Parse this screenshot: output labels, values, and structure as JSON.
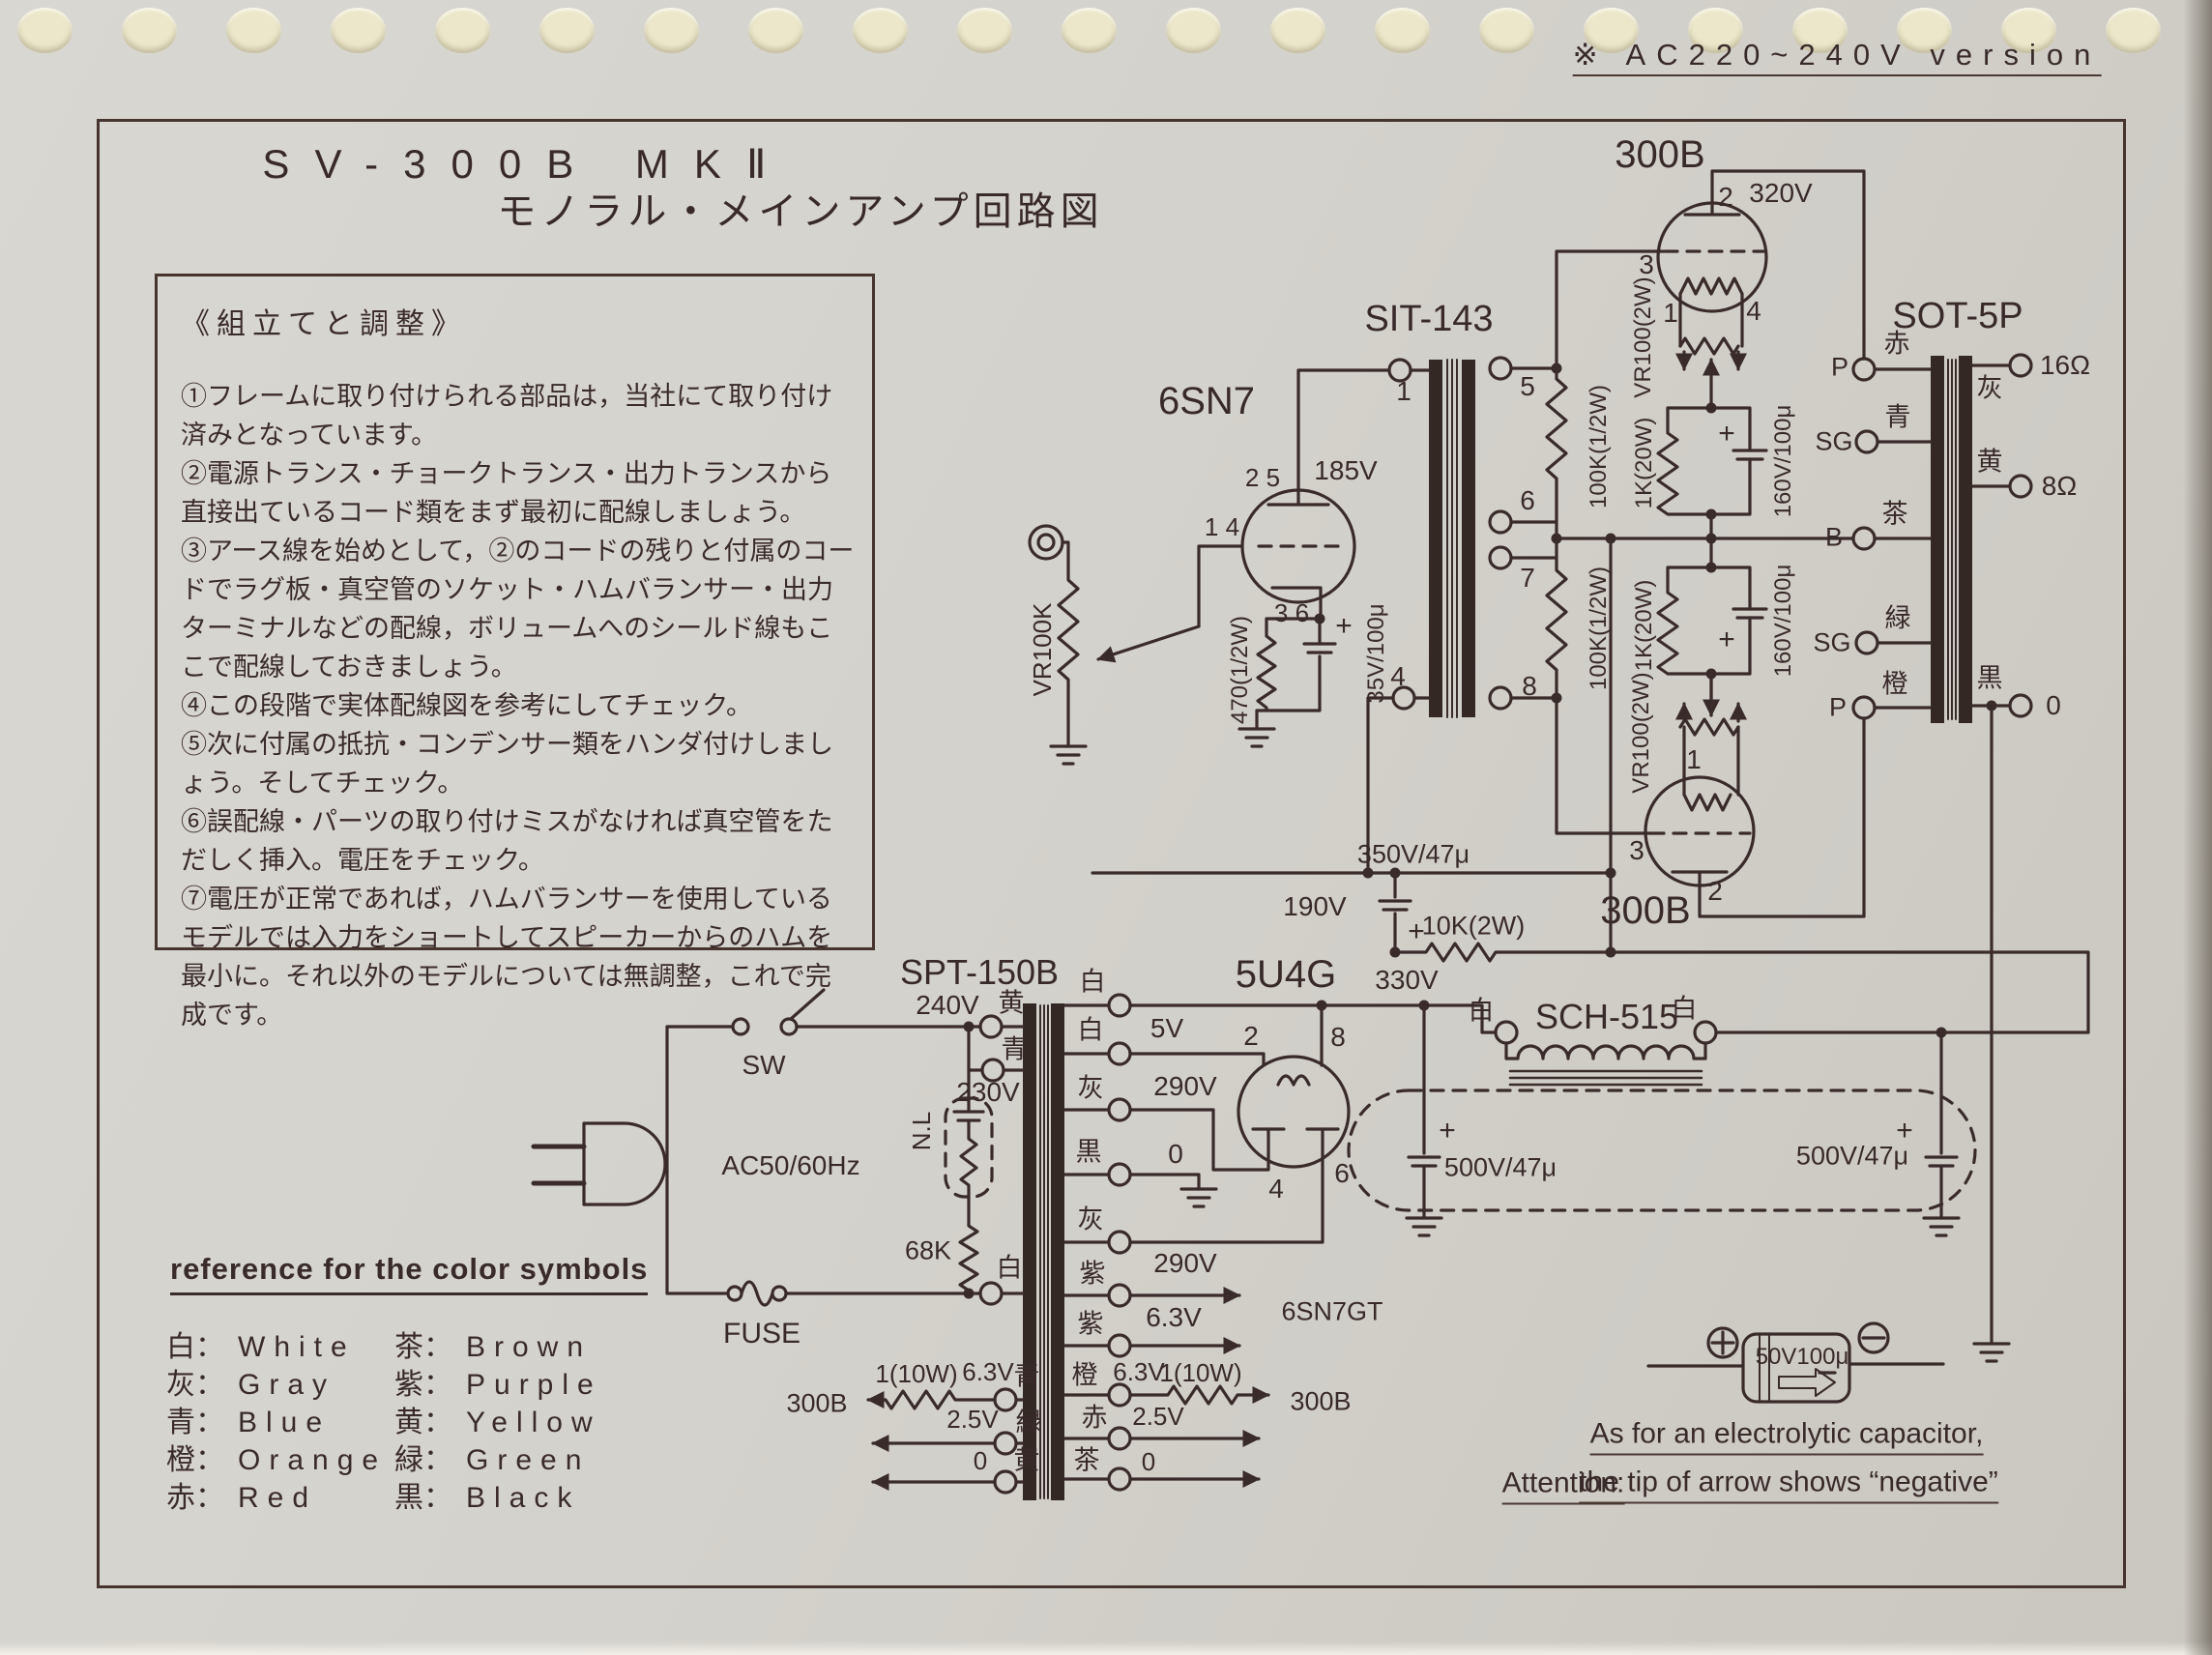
{
  "page": {
    "version_note": "※ AC220~240V version",
    "title_line1": "SV-300B MKⅡ",
    "title_line2": "モノラル・メインアンプ回路図"
  },
  "instructions": {
    "heading": "《組立てと調整》",
    "items": [
      "①フレームに取り付けられる部品は，当社にて取り付け済みとなっています。",
      "②電源トランス・チョークトランス・出力トランスから直接出ているコード類をまず最初に配線しましょう。",
      "③アース線を始めとして，②のコードの残りと付属のコードでラグ板・真空管のソケット・ハムバランサー・出力ターミナルなどの配線，ボリュームへのシールド線もここで配線しておきましょう。",
      "④この段階で実体配線図を参考にしてチェック。",
      "⑤次に付属の抵抗・コンデンサー類をハンダ付けしましょう。そしてチェック。",
      "⑥誤配線・パーツの取り付けミスがなければ真空管をただしく挿入。電圧をチェック。",
      "⑦電圧が正常であれば，ハムバランサーを使用しているモデルでは入力をショートしてスピーカーからのハムを最小に。それ以外のモデルについては無調整，これで完成です。"
    ]
  },
  "components": {
    "driver_tube": "6SN7",
    "interstage_transformer": "SIT-143",
    "output_tube_top": "300B",
    "output_tube_bottom": "300B",
    "output_transformer": "SOT-5P",
    "power_transformer": "SPT-150B",
    "rectifier_tube": "5U4G",
    "choke": "SCH-515"
  },
  "labels": {
    "vr100k": "VR100K",
    "r470": "470(1/2W)",
    "c35": "35V/100μ",
    "v185": "185V",
    "pins25": "2 5",
    "pins14": "1 4",
    "pins36": "3 6",
    "plus": "+",
    "sit1": "1",
    "sit4": "4",
    "sit5": "5",
    "sit6": "6",
    "sit7": "7",
    "sit8": "8",
    "r100k_a": "100K(1/2W)",
    "r100k_b": "100K(1/2W)",
    "t300_pin2": "2",
    "v320": "320V",
    "t300_pin3": "3",
    "t300_pin1": "1",
    "t300_pin4": "4",
    "vr100_top": "VR100(2W)",
    "vr100_bot": "VR100(2W)",
    "r1k_top": "1K(20W)",
    "r1k_bot": "1K(20W)",
    "c160_top": "160V/100μ",
    "c160_bot": "160V/100μ",
    "b300_pin1": "1",
    "b300_pin3": "3",
    "b300_pin2": "2",
    "sot_p1": "P",
    "sot_sg1": "SG",
    "sot_b": "B",
    "sot_sg2": "SG",
    "sot_p2": "P",
    "clr_red": "赤",
    "clr_blue": "青",
    "clr_brown": "茶",
    "clr_green": "緑",
    "clr_orange": "橙",
    "clr_gray16": "灰",
    "clr_yellow8": "黄",
    "clr_black0": "黒",
    "ohm16": "16Ω",
    "ohm8": "8Ω",
    "out0": "0",
    "c350": "350V/47μ",
    "v190": "190V",
    "r10k": "10K(2W)",
    "v330": "330V",
    "c500_a": "500V/47μ",
    "c500_b": "500V/47μ",
    "sw": "SW",
    "fuse": "FUSE",
    "ac": "AC50/60Hz",
    "nl": "N.L",
    "r68k": "68K",
    "v240": "240V",
    "v230": "230V",
    "p_yellow": "黄",
    "p_blue": "青",
    "p_white": "白",
    "s_white1": "白",
    "s_white2": "白",
    "v5": "5V",
    "s_gray1": "灰",
    "v290a": "290V",
    "s_black": "黒",
    "s_zero": "0",
    "s_gray2": "灰",
    "v290b": "290V",
    "h_purple1": "紫",
    "h_purple2": "紫",
    "v63": "6.3V",
    "dest_6sn7": "6SN7GT",
    "hl_r": "1(10W)",
    "hl_v63": "6.3V",
    "hl_blue": "青",
    "dest_300b_l": "300B",
    "hl_v25": "2.5V",
    "hl_green": "緑",
    "hl_zero": "0",
    "hl_yellow": "黄",
    "hr_orange": "橙",
    "hr_v63": "6.3V",
    "hr_r": "1(10W)",
    "dest_300b_r": "300B",
    "hr_red": "赤",
    "hr_v25": "2.5V",
    "hr_brown": "茶",
    "hr_zero": "0",
    "ch_white_l": "白",
    "ch_white_r": "白",
    "u5_pin2": "2",
    "u5_pin8": "8",
    "u5_pin4": "4",
    "u5_pin6": "6"
  },
  "color_reference": {
    "title": "reference for the color symbols",
    "entries": [
      {
        "symbol": "白",
        "name": "White"
      },
      {
        "symbol": "灰",
        "name": "Gray"
      },
      {
        "symbol": "青",
        "name": "Blue"
      },
      {
        "symbol": "橙",
        "name": "Orange"
      },
      {
        "symbol": "赤",
        "name": "Red"
      },
      {
        "symbol": "茶",
        "name": "Brown"
      },
      {
        "symbol": "紫",
        "name": "Purple"
      },
      {
        "symbol": "黄",
        "name": "Yellow"
      },
      {
        "symbol": "緑",
        "name": "Green"
      },
      {
        "symbol": "黒",
        "name": "Black"
      }
    ]
  },
  "capacitor_note": {
    "value": "50V100μ",
    "line1": "As for an electrolytic capacitor,",
    "attention": "Attention:",
    "line2": "the tip of arrow shows “negative”"
  }
}
